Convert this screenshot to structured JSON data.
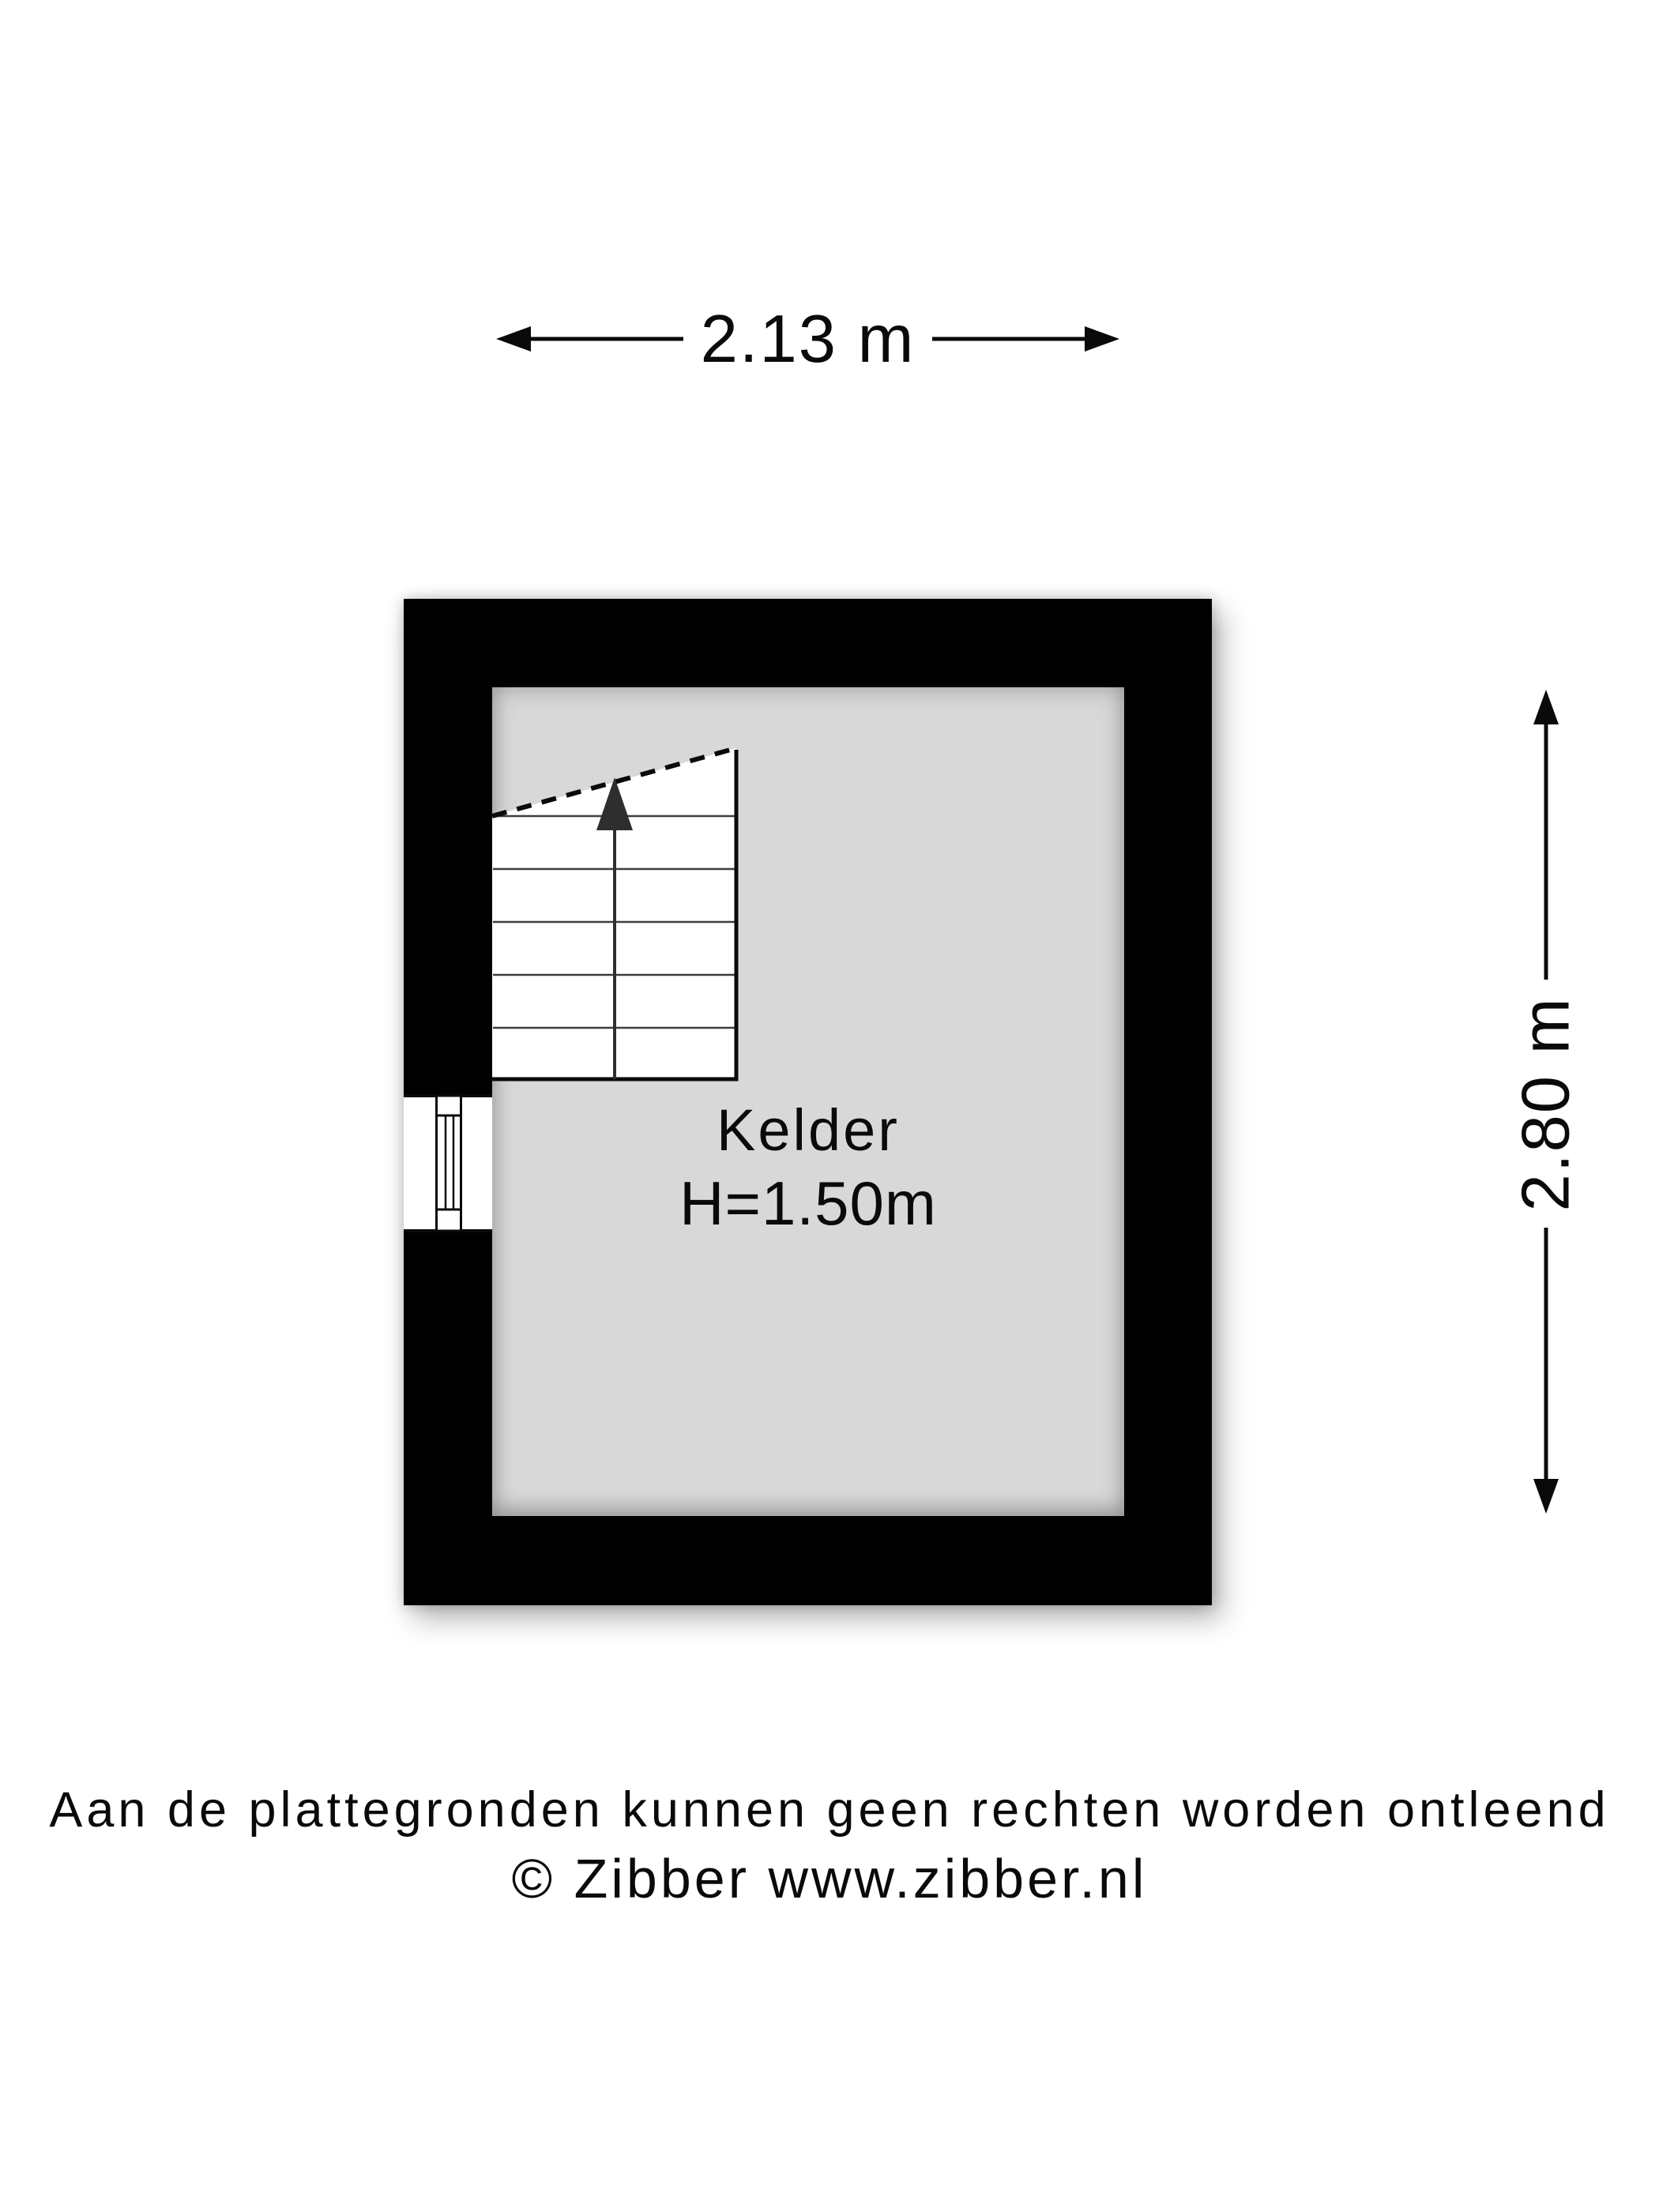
{
  "plan": {
    "room": {
      "name": "Kelder",
      "height_label": "H=1.50m"
    },
    "dimensions": {
      "width_label": "2.13 m",
      "height_label": "2.80 m"
    },
    "features": [
      "staircase-with-up-arrow",
      "window-left-wall"
    ]
  },
  "footer": {
    "disclaimer": "Aan de plattegronden kunnen geen rechten worden ontleend",
    "copyright": "© Zibber www.zibber.nl"
  },
  "colors": {
    "wall": "#000000",
    "floor": "#d8d8d8",
    "stair-fill": "#ffffff",
    "tread-line": "#3d3d3d",
    "arrow-dark": "#2e2e2e",
    "ink": "#0a0a0a",
    "page-bg": "#ffffff"
  }
}
